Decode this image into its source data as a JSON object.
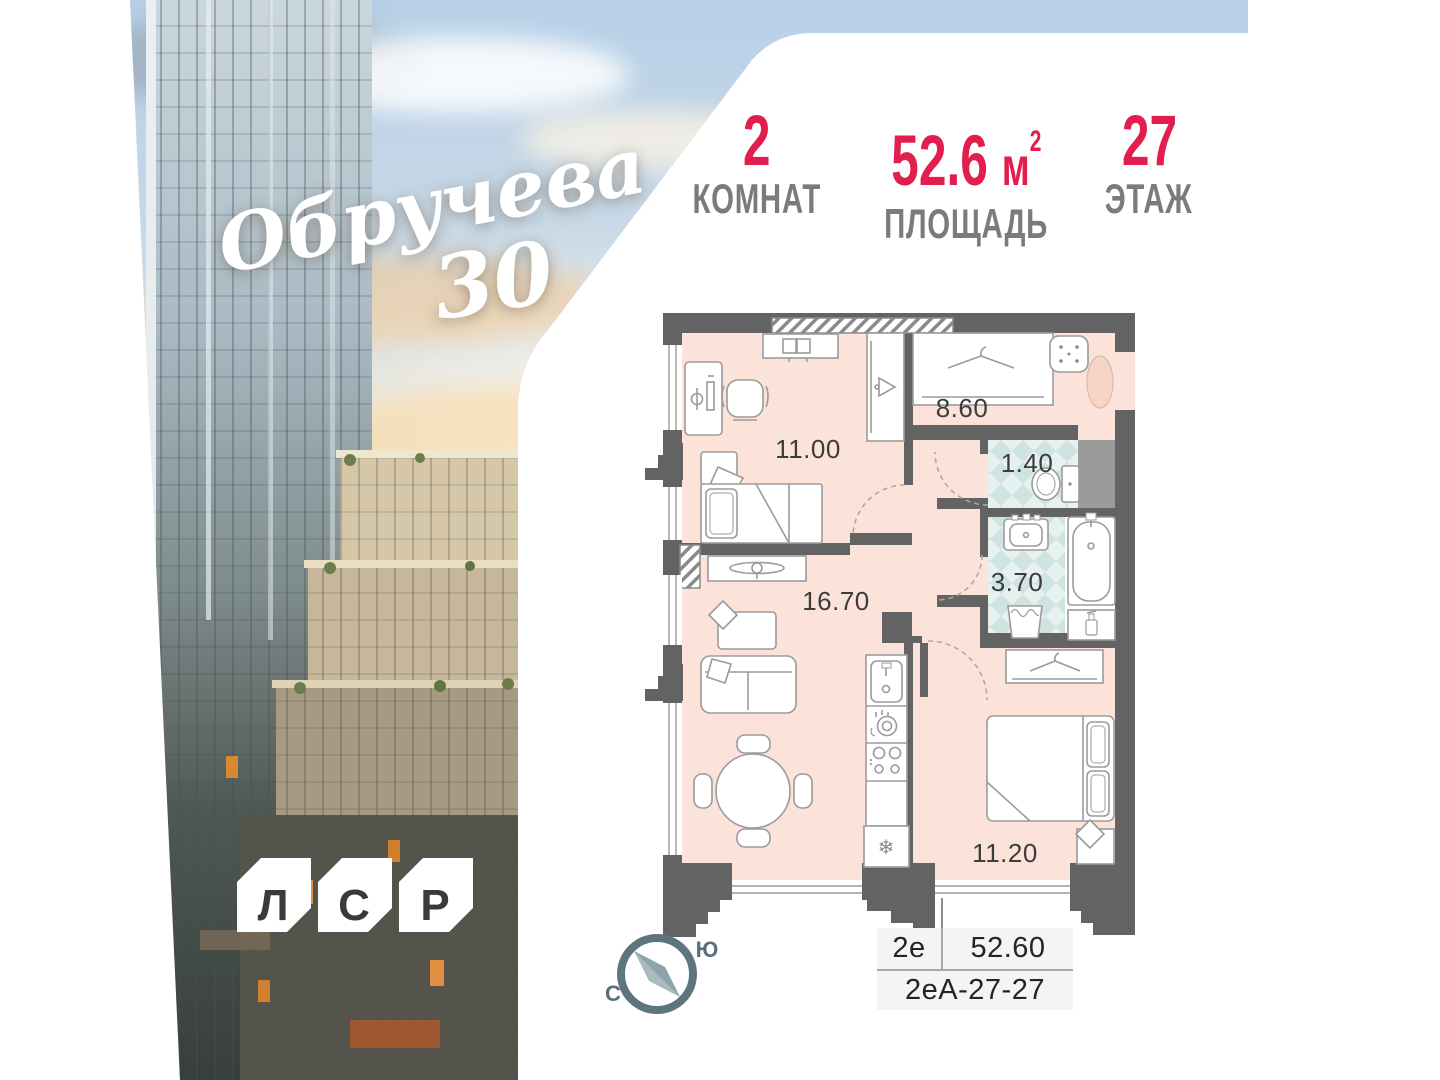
{
  "brand": {
    "script": "Обручева",
    "number": "30"
  },
  "stats": {
    "rooms": {
      "value": "2",
      "label": "КОМНАТ"
    },
    "area": {
      "value": "52.6",
      "unit": "м",
      "sup": "2",
      "label": "ПЛОЩАДЬ"
    },
    "floor": {
      "value": "27",
      "label": "ЭТАЖ"
    }
  },
  "plan": {
    "rooms": [
      {
        "id": "bedroom-1",
        "area": "11.00"
      },
      {
        "id": "hallway",
        "area": "8.60"
      },
      {
        "id": "wc",
        "area": "1.40"
      },
      {
        "id": "bathroom",
        "area": "3.70"
      },
      {
        "id": "living-kitchen",
        "area": "16.70"
      },
      {
        "id": "bedroom-2",
        "area": "11.20"
      }
    ]
  },
  "compass": {
    "south": "Ю",
    "north": "С"
  },
  "info_table": {
    "layout_type": "2е",
    "area_value": "52.60",
    "apartment_code": "2еА-27-27"
  },
  "developer_logo": {
    "letters": [
      "Л",
      "С",
      "Р"
    ]
  },
  "colors": {
    "accent_red": "#e11e4e",
    "label_gray": "#7b7b7b",
    "wall": "#636363",
    "floor": "#fbe3da",
    "tile": "#e4efee",
    "compass": "#5e7580"
  }
}
